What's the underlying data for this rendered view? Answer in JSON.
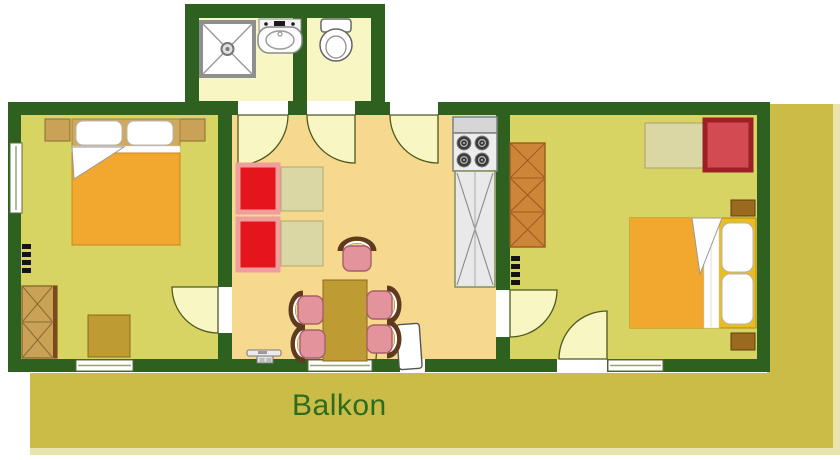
{
  "balcony": {
    "label": "Balkon"
  },
  "colors": {
    "wall": "#2e6120",
    "bedroom_floor": "#d8d463",
    "living_floor": "#f6d88e",
    "bath_floor": "#f8f6c3",
    "door_swing": "#f8f6c3",
    "balcony": "#cbbc48",
    "balcony_edge": "#e9e4ae",
    "balcony_text": "#2e6b1e",
    "blanket": "#f2a72e",
    "bed_base": "#e9bd22",
    "headboard": "#cfa95e",
    "armchair_red": "#e5151c",
    "armchair_trim": "#ef9e9e",
    "lounge_red": "#d44a52",
    "lounge_trim": "#9c2026",
    "chair_pink": "#e2939b",
    "chair_back": "#5f3b1d",
    "dining_table": "#bf9b33",
    "side_table": "#dbd7a5",
    "wardrobe_tan": "#c9a257",
    "wardrobe_orange": "#cd8638",
    "nightstand_dark": "#9a6a1e",
    "kitchen_gray": "#ededed"
  },
  "icons": {
    "shower": "square-with-diagonal-cross-and-drain",
    "washbasin": "rounded-basin-with-faucet",
    "toilet": "tank-and-oval-bowl",
    "stove": "four-burner-cooktop",
    "kitchen-cabinet": "tall-unit-with-cross",
    "wardrobe": "cabinet-with-x-front",
    "double-bed": "mattress-pillows-folded-sheet",
    "nightstand": "small-square",
    "radiator": "comb-marks",
    "armchair": "red-square-with-pink-trim",
    "dining-chair": "pink-seat-with-brown-backrest-arc",
    "dining-table": "brown-rectangle",
    "tv-stand": "bar-on-pedestal",
    "door-swing": "quarter-circle-arc",
    "window": "double-line-in-wall"
  }
}
